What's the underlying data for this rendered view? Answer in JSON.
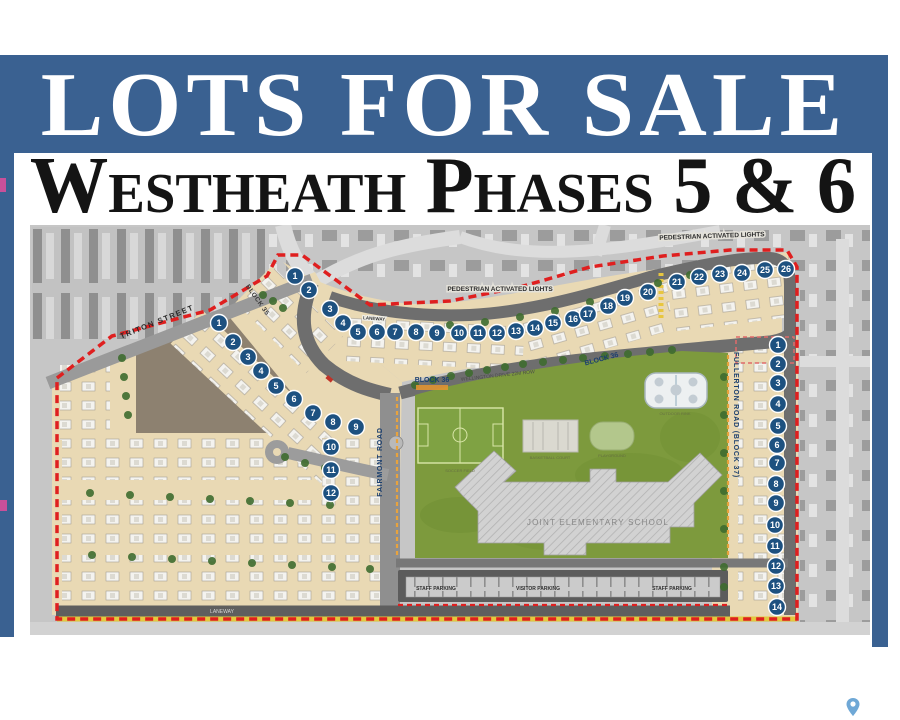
{
  "banner": {
    "title": "LOTS FOR SALE",
    "bg_color": "#3a6191"
  },
  "subtitle": {
    "text": "Westheath Phases 5 & 6"
  },
  "colors": {
    "banner_blue": "#3a6191",
    "lot_circle": "#1d5180",
    "boundary_red": "#df1f1f",
    "lot_tan": "#e9d9b4",
    "park_green": "#7d9a3d",
    "dirt_brown": "#8d8170",
    "road_gray": "#6e6e6e",
    "aerial_gray": "#c6c6c6",
    "fence_orange": "#e8a33d",
    "label_navy": "#1b3f6e"
  },
  "map": {
    "labels": [
      {
        "text": "TRITON STREET",
        "x": 128,
        "y": 99,
        "rot": -22,
        "cls": "street",
        "name": "street-label-triton"
      },
      {
        "text": "BLOCK 35",
        "x": 226,
        "y": 76,
        "rot": 55,
        "cls": "street-sm",
        "name": "block-35-label"
      },
      {
        "text": "LANEWAY",
        "x": 344,
        "y": 95,
        "rot": 4,
        "cls": "chip-sm",
        "name": "laneway-top-label"
      },
      {
        "text": "PEDESTRIAN ACTIVATED LIGHTS",
        "x": 470,
        "y": 66,
        "rot": 0,
        "cls": "chip",
        "name": "pedestrian-lights-label-west"
      },
      {
        "text": "PEDESTRIAN ACTIVATED LIGHTS",
        "x": 682,
        "y": 13,
        "rot": -2,
        "cls": "chip",
        "name": "pedestrian-lights-label-east"
      },
      {
        "text": "WELLINGTON DRIVE 22M ROW",
        "x": 468,
        "y": 152,
        "rot": -6,
        "cls": "tiny-gray",
        "name": "street-label-wellington"
      },
      {
        "text": "BLOCK 36",
        "x": 402,
        "y": 157,
        "rot": 0,
        "cls": "block-navy",
        "name": "block-36-label-west"
      },
      {
        "text": "BLOCK 36",
        "x": 572,
        "y": 136,
        "rot": -15,
        "cls": "block-navy",
        "name": "block-36-label-east"
      },
      {
        "text": "FAIRMONT ROAD",
        "x": 352,
        "y": 237,
        "rot": -90,
        "cls": "road-navy",
        "name": "street-label-fairmont"
      },
      {
        "text": "FULLERTON ROAD (BLOCK 37)",
        "x": 704,
        "y": 190,
        "rot": 90,
        "cls": "road-navy",
        "name": "street-label-fullerton"
      },
      {
        "text": "LANEWAY",
        "x": 192,
        "y": 388,
        "rot": 0,
        "cls": "tiny-light",
        "name": "laneway-bottom-label"
      },
      {
        "text": "JOINT ELEMENTARY SCHOOL",
        "x": 568,
        "y": 300,
        "rot": 0,
        "cls": "school",
        "name": "school-label"
      },
      {
        "text": "STAFF PARKING",
        "x": 406,
        "y": 365,
        "rot": 0,
        "cls": "parking",
        "name": "staff-parking-label-west"
      },
      {
        "text": "VISITOR PARKING",
        "x": 508,
        "y": 365,
        "rot": 0,
        "cls": "parking",
        "name": "visitor-parking-label"
      },
      {
        "text": "STAFF PARKING",
        "x": 642,
        "y": 365,
        "rot": 0,
        "cls": "parking",
        "name": "staff-parking-label-east"
      },
      {
        "text": "SOCCER FIELD",
        "x": 430,
        "y": 247,
        "rot": 0,
        "cls": "micro",
        "name": "soccer-field-label"
      },
      {
        "text": "BASKETBALL COURT",
        "x": 520,
        "y": 234,
        "rot": 0,
        "cls": "micro",
        "name": "basketball-court-label"
      },
      {
        "text": "PLAYGROUND",
        "x": 582,
        "y": 232,
        "rot": 0,
        "cls": "micro",
        "name": "playground-label"
      },
      {
        "text": "OUTDOOR RINK",
        "x": 645,
        "y": 190,
        "rot": 0,
        "cls": "micro",
        "name": "rink-label"
      }
    ],
    "lot_groups": [
      {
        "name": "block-36-lots",
        "numbers": [
          1,
          2,
          3,
          4,
          5,
          6,
          7,
          8,
          9,
          10,
          11,
          12,
          13,
          14,
          15,
          16,
          17,
          18,
          19,
          20,
          21,
          22,
          23,
          24,
          25,
          26
        ],
        "positions": [
          [
            265,
            51
          ],
          [
            279,
            65
          ],
          [
            300,
            84
          ],
          [
            313,
            98
          ],
          [
            328,
            107
          ],
          [
            347,
            107
          ],
          [
            365,
            107
          ],
          [
            386,
            107
          ],
          [
            407,
            108
          ],
          [
            429,
            108
          ],
          [
            448,
            108
          ],
          [
            467,
            108
          ],
          [
            486,
            106
          ],
          [
            505,
            103
          ],
          [
            523,
            98
          ],
          [
            543,
            94
          ],
          [
            558,
            89
          ],
          [
            578,
            81
          ],
          [
            595,
            73
          ],
          [
            618,
            67
          ],
          [
            647,
            57
          ],
          [
            669,
            52
          ],
          [
            690,
            49
          ],
          [
            712,
            48
          ],
          [
            735,
            45
          ],
          [
            756,
            44
          ]
        ]
      },
      {
        "name": "block-35-lots",
        "numbers": [
          1,
          2,
          3,
          4,
          5,
          6,
          7,
          8,
          9,
          10,
          11,
          12
        ],
        "positions": [
          [
            189,
            98
          ],
          [
            203,
            117
          ],
          [
            218,
            132
          ],
          [
            231,
            146
          ],
          [
            246,
            161
          ],
          [
            264,
            174
          ],
          [
            283,
            188
          ],
          [
            303,
            197
          ],
          [
            326,
            202
          ],
          [
            301,
            222
          ],
          [
            301,
            245
          ],
          [
            301,
            268
          ]
        ]
      },
      {
        "name": "block-37-lots",
        "numbers": [
          1,
          2,
          3,
          4,
          5,
          6,
          7,
          8,
          9,
          10,
          11,
          12,
          13,
          14
        ],
        "positions": [
          [
            748,
            120
          ],
          [
            748,
            139
          ],
          [
            748,
            158
          ],
          [
            748,
            179
          ],
          [
            748,
            201
          ],
          [
            747,
            220
          ],
          [
            747,
            238
          ],
          [
            746,
            259
          ],
          [
            746,
            278
          ],
          [
            745,
            300
          ],
          [
            745,
            321
          ],
          [
            746,
            341
          ],
          [
            746,
            361
          ],
          [
            747,
            382
          ]
        ]
      }
    ],
    "trees": [
      [
        385,
        160
      ],
      [
        403,
        155
      ],
      [
        421,
        151
      ],
      [
        439,
        148
      ],
      [
        457,
        145
      ],
      [
        475,
        142
      ],
      [
        493,
        139
      ],
      [
        513,
        137
      ],
      [
        533,
        135
      ],
      [
        553,
        133
      ],
      [
        575,
        131
      ],
      [
        598,
        129
      ],
      [
        620,
        127
      ],
      [
        642,
        125
      ],
      [
        233,
        70
      ],
      [
        243,
        76
      ],
      [
        253,
        83
      ],
      [
        420,
        100
      ],
      [
        455,
        97
      ],
      [
        490,
        92
      ],
      [
        525,
        86
      ],
      [
        560,
        77
      ],
      [
        595,
        68
      ],
      [
        628,
        58
      ],
      [
        660,
        50
      ],
      [
        692,
        44
      ],
      [
        92,
        133
      ],
      [
        94,
        152
      ],
      [
        96,
        171
      ],
      [
        98,
        190
      ],
      [
        255,
        232
      ],
      [
        275,
        238
      ],
      [
        295,
        243
      ],
      [
        60,
        268
      ],
      [
        100,
        270
      ],
      [
        140,
        272
      ],
      [
        180,
        274
      ],
      [
        220,
        276
      ],
      [
        260,
        278
      ],
      [
        300,
        280
      ],
      [
        62,
        330
      ],
      [
        102,
        332
      ],
      [
        142,
        334
      ],
      [
        182,
        336
      ],
      [
        222,
        338
      ],
      [
        262,
        340
      ],
      [
        302,
        342
      ],
      [
        340,
        344
      ],
      [
        694,
        152
      ],
      [
        694,
        190
      ],
      [
        694,
        228
      ],
      [
        694,
        266
      ],
      [
        694,
        304
      ],
      [
        694,
        342
      ],
      [
        694,
        362
      ]
    ]
  },
  "footer": {
    "pin_icon": "map-pin"
  }
}
